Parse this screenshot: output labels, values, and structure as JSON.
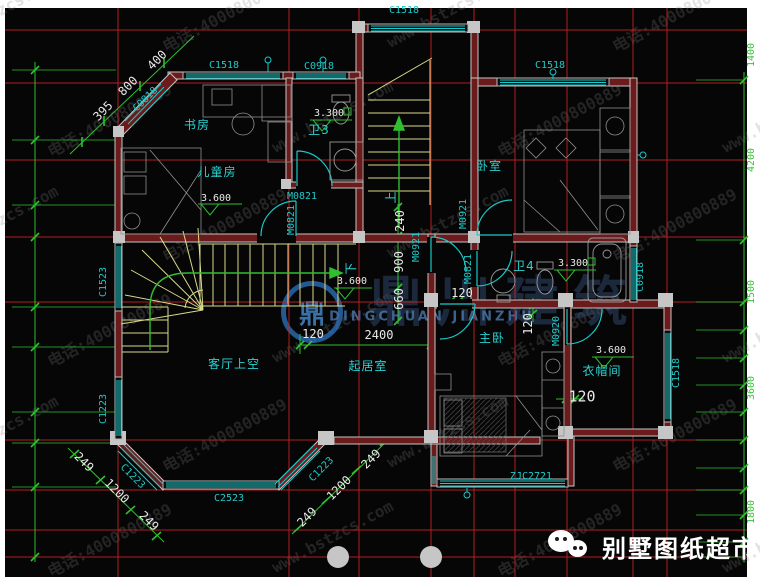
{
  "colors": {
    "background": "#060606",
    "axis_red": "#c42222",
    "dim_green": "#2fbf2f",
    "label_cyan": "#1fc9c9",
    "dim_white": "#e8e8e8",
    "wall_gray": "#c6c6c6",
    "wall_core_red": "#6b1b1b",
    "stair_yellow": "#d9d98a",
    "watermark_blue": "#2f74c0"
  },
  "watermarks": {
    "tile_text_1": "www.bstzcs.com",
    "tile_text_2": "电话:4000800889",
    "logo_glyph": "鼎",
    "brand": "鼎川建筑",
    "brand_caption": "DINGCHUAN JIANZHU",
    "footer_brand": "别墅图纸超市"
  },
  "texts": [
    {
      "n": "window-label",
      "t": "C1518",
      "x": 404,
      "y": 11,
      "c": "c"
    },
    {
      "n": "window-label",
      "t": "C1518",
      "x": 224,
      "y": 66,
      "c": "c"
    },
    {
      "n": "window-label",
      "t": "C0918",
      "x": 319,
      "y": 67,
      "c": "c"
    },
    {
      "n": "window-label",
      "t": "C1518",
      "x": 550,
      "y": 66,
      "c": "c"
    },
    {
      "n": "window-label",
      "t": "C0818",
      "x": 146,
      "y": 100,
      "c": "c",
      "r": -45
    },
    {
      "n": "window-label",
      "t": "C1523",
      "x": 104,
      "y": 282,
      "c": "c",
      "r": -90
    },
    {
      "n": "window-label",
      "t": "C1223",
      "x": 104,
      "y": 409,
      "c": "c",
      "r": -90
    },
    {
      "n": "window-label",
      "t": "C1223",
      "x": 132,
      "y": 477,
      "c": "c",
      "r": 45
    },
    {
      "n": "window-label",
      "t": "C1223",
      "x": 322,
      "y": 470,
      "c": "c",
      "r": -45
    },
    {
      "n": "window-label",
      "t": "C2523",
      "x": 229,
      "y": 499,
      "c": "c"
    },
    {
      "n": "window-label",
      "t": "C0918",
      "x": 641,
      "y": 277,
      "c": "c",
      "r": -90
    },
    {
      "n": "window-label",
      "t": "C1518",
      "x": 677,
      "y": 373,
      "c": "c",
      "r": -90
    },
    {
      "n": "window-label",
      "t": "ZJC2721",
      "x": 531,
      "y": 477,
      "c": "c"
    },
    {
      "n": "door-label",
      "t": "M0821",
      "x": 302,
      "y": 197,
      "c": "c"
    },
    {
      "n": "door-label",
      "t": "M0821",
      "x": 292,
      "y": 220,
      "c": "c",
      "r": -90
    },
    {
      "n": "door-label",
      "t": "M0921",
      "x": 464,
      "y": 214,
      "c": "c",
      "r": -90
    },
    {
      "n": "door-label",
      "t": "M0921",
      "x": 417,
      "y": 247,
      "c": "c",
      "r": -90
    },
    {
      "n": "door-label",
      "t": "M0821",
      "x": 469,
      "y": 269,
      "c": "c",
      "r": -90
    },
    {
      "n": "door-label",
      "t": "M0920",
      "x": 557,
      "y": 331,
      "c": "c",
      "r": -90
    },
    {
      "n": "room-label",
      "t": "书房",
      "x": 197,
      "y": 125,
      "c": "room"
    },
    {
      "n": "room-label",
      "t": "卫3",
      "x": 319,
      "y": 130,
      "c": "room"
    },
    {
      "n": "room-label",
      "t": "儿童房",
      "x": 217,
      "y": 172,
      "c": "room"
    },
    {
      "n": "room-label",
      "t": "卧室",
      "x": 489,
      "y": 166,
      "c": "room"
    },
    {
      "n": "room-label",
      "t": "卫4",
      "x": 524,
      "y": 266,
      "c": "room"
    },
    {
      "n": "room-label",
      "t": "主卧",
      "x": 492,
      "y": 338,
      "c": "room"
    },
    {
      "n": "room-label",
      "t": "衣帽间",
      "x": 602,
      "y": 371,
      "c": "room"
    },
    {
      "n": "room-label",
      "t": "客厅上空",
      "x": 234,
      "y": 364,
      "c": "room"
    },
    {
      "n": "room-label",
      "t": "起居室",
      "x": 368,
      "y": 366,
      "c": "room"
    },
    {
      "n": "stair-direction-label",
      "t": "上",
      "x": 391,
      "y": 197,
      "c": "room",
      "r": -90
    },
    {
      "n": "stair-direction-label",
      "t": "下",
      "x": 351,
      "y": 268,
      "c": "room",
      "r": -90
    },
    {
      "n": "dim-label",
      "t": "395",
      "x": 103,
      "y": 111,
      "c": "w",
      "r": -45
    },
    {
      "n": "dim-label",
      "t": "800",
      "x": 128,
      "y": 86,
      "c": "w",
      "r": -45
    },
    {
      "n": "dim-label",
      "t": "400",
      "x": 157,
      "y": 60,
      "c": "w",
      "r": -45
    },
    {
      "n": "dim-label",
      "t": "240",
      "x": 400,
      "y": 221,
      "c": "w",
      "r": -90
    },
    {
      "n": "dim-label",
      "t": "900",
      "x": 399,
      "y": 262,
      "c": "w",
      "r": -90
    },
    {
      "n": "dim-label",
      "t": "660",
      "x": 399,
      "y": 299,
      "c": "w",
      "r": -90
    },
    {
      "n": "dim-label",
      "t": "120",
      "x": 313,
      "y": 334,
      "c": "w"
    },
    {
      "n": "dim-label",
      "t": "2400",
      "x": 379,
      "y": 335,
      "c": "w"
    },
    {
      "n": "dim-label",
      "t": "120",
      "x": 462,
      "y": 293,
      "c": "w"
    },
    {
      "n": "dim-label",
      "t": "120",
      "x": 528,
      "y": 324,
      "c": "w",
      "r": -90
    },
    {
      "n": "dim-label",
      "t": "120",
      "x": 582,
      "y": 397,
      "c": "w",
      "s": 15
    },
    {
      "n": "dim-label",
      "t": "249",
      "x": 84,
      "y": 462,
      "c": "w",
      "r": 45
    },
    {
      "n": "dim-label",
      "t": "1200",
      "x": 117,
      "y": 491,
      "c": "w",
      "r": 45
    },
    {
      "n": "dim-label",
      "t": "249",
      "x": 149,
      "y": 521,
      "c": "w",
      "r": 45
    },
    {
      "n": "dim-label",
      "t": "249",
      "x": 371,
      "y": 459,
      "c": "w",
      "r": -45
    },
    {
      "n": "dim-label",
      "t": "1200",
      "x": 339,
      "y": 488,
      "c": "w",
      "r": -45
    },
    {
      "n": "dim-label",
      "t": "249",
      "x": 307,
      "y": 517,
      "c": "w",
      "r": -45
    },
    {
      "n": "level-label",
      "t": "3.300",
      "x": 329,
      "y": 114,
      "c": "w",
      "s": 10
    },
    {
      "n": "level-label",
      "t": "3.600",
      "x": 216,
      "y": 199,
      "c": "w",
      "s": 10
    },
    {
      "n": "level-label",
      "t": "3.300",
      "x": 573,
      "y": 264,
      "c": "w",
      "s": 10
    },
    {
      "n": "level-label",
      "t": "3.600",
      "x": 352,
      "y": 282,
      "c": "w",
      "s": 10
    },
    {
      "n": "level-label",
      "t": "3.600",
      "x": 611,
      "y": 351,
      "c": "w",
      "s": 10
    },
    {
      "n": "dim-label",
      "t": "1400",
      "x": 752,
      "y": 55,
      "c": "g",
      "r": -90
    },
    {
      "n": "dim-label",
      "t": "4200",
      "x": 752,
      "y": 160,
      "c": "g",
      "r": -90
    },
    {
      "n": "dim-label",
      "t": "1500",
      "x": 752,
      "y": 292,
      "c": "g",
      "r": -90
    },
    {
      "n": "dim-label",
      "t": "3600",
      "x": 752,
      "y": 388,
      "c": "g",
      "r": -90
    },
    {
      "n": "dim-label",
      "t": "1800",
      "x": 752,
      "y": 512,
      "c": "g",
      "r": -90
    }
  ]
}
